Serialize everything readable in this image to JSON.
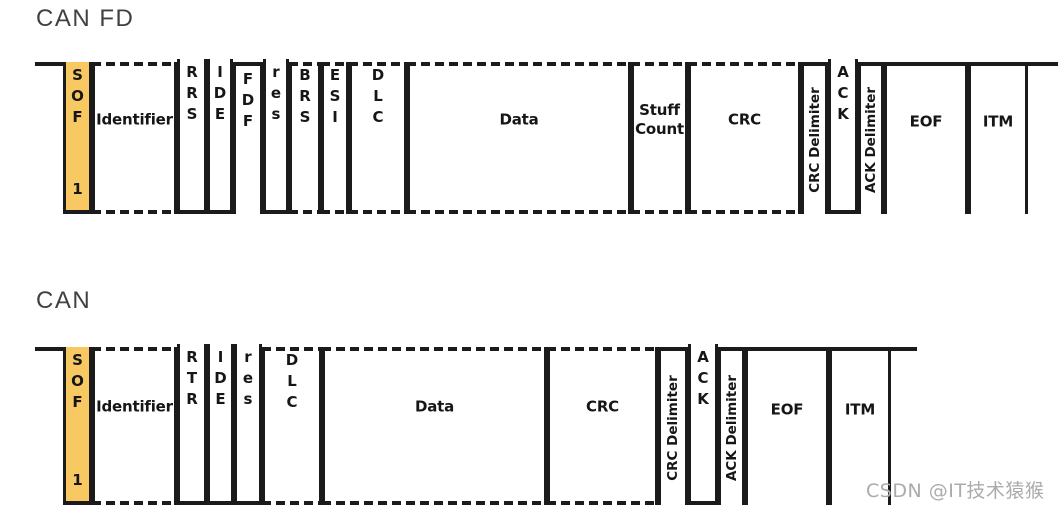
{
  "canfd": {
    "title": "CAN FD",
    "segments": [
      {
        "name": "lead-line",
        "x": 35,
        "w": 31
      },
      {
        "name": "trail-line",
        "x": 1028,
        "w": 30
      }
    ],
    "fields": [
      {
        "label": "SOF",
        "bit": "1",
        "level": "sof",
        "label_style": "stack",
        "x": 63,
        "w": 29
      },
      {
        "label": "Identifier",
        "level": "either",
        "label_style": "horiz",
        "x": 92,
        "w": 85
      },
      {
        "label": "RRS",
        "level": "low",
        "label_style": "stack",
        "x": 177,
        "w": 30
      },
      {
        "label": "IDE",
        "level": "low",
        "label_style": "stack",
        "x": 207,
        "w": 26
      },
      {
        "label": "FDF",
        "level": "high",
        "label_style": "stack",
        "x": 233,
        "w": 30
      },
      {
        "label": "res",
        "level": "low",
        "label_style": "stack",
        "x": 263,
        "w": 26
      },
      {
        "label": "BRS",
        "level": "either",
        "label_style": "stack",
        "x": 289,
        "w": 32
      },
      {
        "label": "ESI",
        "level": "either",
        "label_style": "stack",
        "x": 321,
        "w": 28
      },
      {
        "label": "DLC",
        "level": "either",
        "label_style": "stack",
        "x": 349,
        "w": 58
      },
      {
        "label": "Data",
        "level": "either",
        "label_style": "horiz",
        "x": 407,
        "w": 224
      },
      {
        "label": "Stuff Count",
        "level": "either",
        "label_style": "horiz",
        "wrap": true,
        "x": 631,
        "w": 57
      },
      {
        "label": "CRC",
        "level": "either",
        "label_style": "horiz",
        "x": 688,
        "w": 113
      },
      {
        "label": "CRC Delimiter",
        "level": "high",
        "label_style": "rot",
        "x": 801,
        "w": 27
      },
      {
        "label": "ACK",
        "level": "low",
        "label_style": "stack",
        "x": 828,
        "w": 30
      },
      {
        "label": "ACK Delimiter",
        "level": "high",
        "label_style": "rot",
        "x": 858,
        "w": 26
      },
      {
        "label": "EOF",
        "level": "high",
        "label_style": "horiz",
        "x": 884,
        "w": 84
      },
      {
        "label": "ITM",
        "level": "high",
        "label_style": "horiz",
        "x": 968,
        "w": 60
      }
    ]
  },
  "can": {
    "title": "CAN",
    "segments": [
      {
        "name": "lead-line",
        "x": 35,
        "w": 31
      },
      {
        "name": "trail-line",
        "x": 891,
        "w": 26
      }
    ],
    "fields": [
      {
        "label": "SOF",
        "bit": "1",
        "level": "sof",
        "label_style": "stack",
        "x": 63,
        "w": 29
      },
      {
        "label": "Identifier",
        "level": "either",
        "label_style": "horiz",
        "x": 92,
        "w": 85
      },
      {
        "label": "RTR",
        "level": "low",
        "label_style": "stack",
        "x": 177,
        "w": 30
      },
      {
        "label": "IDE",
        "level": "low",
        "label_style": "stack",
        "x": 207,
        "w": 27
      },
      {
        "label": "res",
        "level": "low",
        "label_style": "stack",
        "x": 234,
        "w": 28
      },
      {
        "label": "DLC",
        "level": "either",
        "label_style": "stack",
        "x": 262,
        "w": 60
      },
      {
        "label": "Data",
        "level": "either",
        "label_style": "horiz",
        "x": 322,
        "w": 225
      },
      {
        "label": "CRC",
        "level": "either",
        "label_style": "horiz",
        "x": 547,
        "w": 111
      },
      {
        "label": "CRC Delimiter",
        "level": "high",
        "label_style": "rot",
        "x": 658,
        "w": 30
      },
      {
        "label": "ACK",
        "level": "low",
        "label_style": "stack",
        "x": 688,
        "w": 30
      },
      {
        "label": "ACK Delimiter",
        "level": "high",
        "label_style": "rot",
        "x": 718,
        "w": 27
      },
      {
        "label": "EOF",
        "level": "high",
        "label_style": "horiz",
        "x": 745,
        "w": 84
      },
      {
        "label": "ITM",
        "level": "high",
        "label_style": "horiz",
        "x": 829,
        "w": 62
      }
    ]
  },
  "watermark": "CSDN @IT技术猿猴",
  "colors": {
    "line": "#1B1B1B",
    "sof_fill": "#F8C862",
    "title_text": "#414141",
    "watermark_text": "#ABABAB"
  }
}
